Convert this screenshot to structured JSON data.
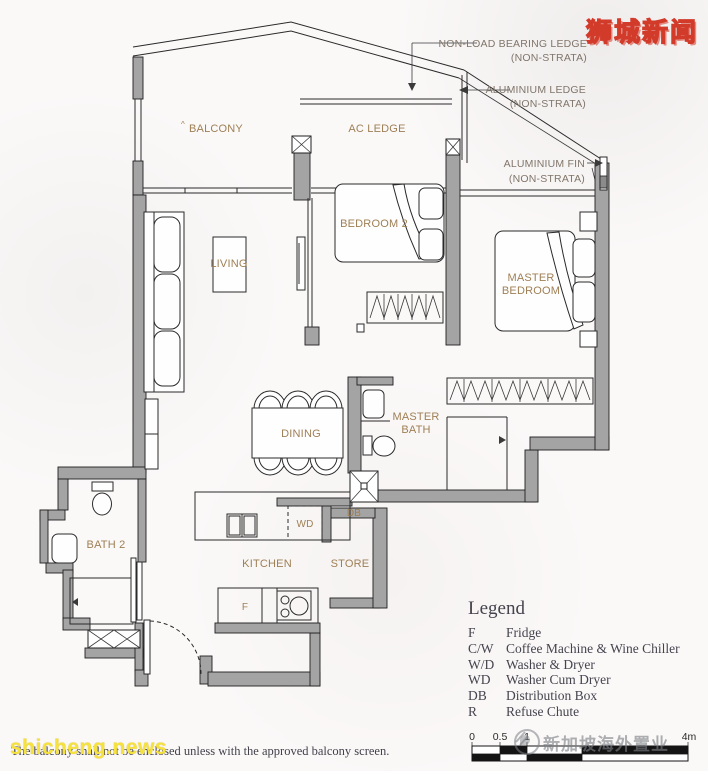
{
  "watermarks": {
    "site_logo": "狮城新闻",
    "site_url": "shicheng.news",
    "agency": "新加坡海外置业"
  },
  "annotations": {
    "non_load_bearing_ledge_line1": "NON-LOAD BEARING LEDGE",
    "non_load_bearing_ledge_line2": "(NON-STRATA)",
    "aluminium_ledge_line1": "ALUMINIUM LEDGE",
    "aluminium_ledge_line2": "(NON-STRATA)",
    "aluminium_fin_line1": "ALUMINIUM FIN",
    "aluminium_fin_line2": "(NON-STRATA)"
  },
  "rooms": {
    "balcony_sup": "^",
    "balcony": "BALCONY",
    "ac_ledge": "AC LEDGE",
    "living": "LIVING",
    "bedroom2": "BEDROOM 2",
    "master_bedroom_line1": "MASTER",
    "master_bedroom_line2": "BEDROOM",
    "dining": "DINING",
    "master_bath_line1": "MASTER",
    "master_bath_line2": "BATH",
    "bath2": "BATH 2",
    "kitchen": "KITCHEN",
    "store": "STORE",
    "wd": "WD",
    "db": "DB",
    "fridge": "F"
  },
  "legend": {
    "title": "Legend",
    "items": [
      {
        "abbr": "F",
        "desc": "Fridge"
      },
      {
        "abbr": "C/W",
        "desc": "Coffee Machine & Wine Chiller"
      },
      {
        "abbr": "W/D",
        "desc": "Washer & Dryer"
      },
      {
        "abbr": "WD",
        "desc": "Washer Cum Dryer"
      },
      {
        "abbr": "DB",
        "desc": "Distribution Box"
      },
      {
        "abbr": "R",
        "desc": "Refuse Chute"
      }
    ]
  },
  "scale_bar": {
    "labels": [
      "0",
      "0.5",
      "1",
      "4m"
    ]
  },
  "footnote": "The balcony shall not be enclosed unless with the approved balcony screen.",
  "colors": {
    "wall": "#a4a4a4",
    "line": "#2a2a2a",
    "room_label": "#9e7f55",
    "annotation": "#80756a",
    "logo_yellow": "#ffe23e",
    "logo_red": "#d23a2a",
    "watermark_yellow": "#f6e23c",
    "text_dark": "#45444e"
  }
}
